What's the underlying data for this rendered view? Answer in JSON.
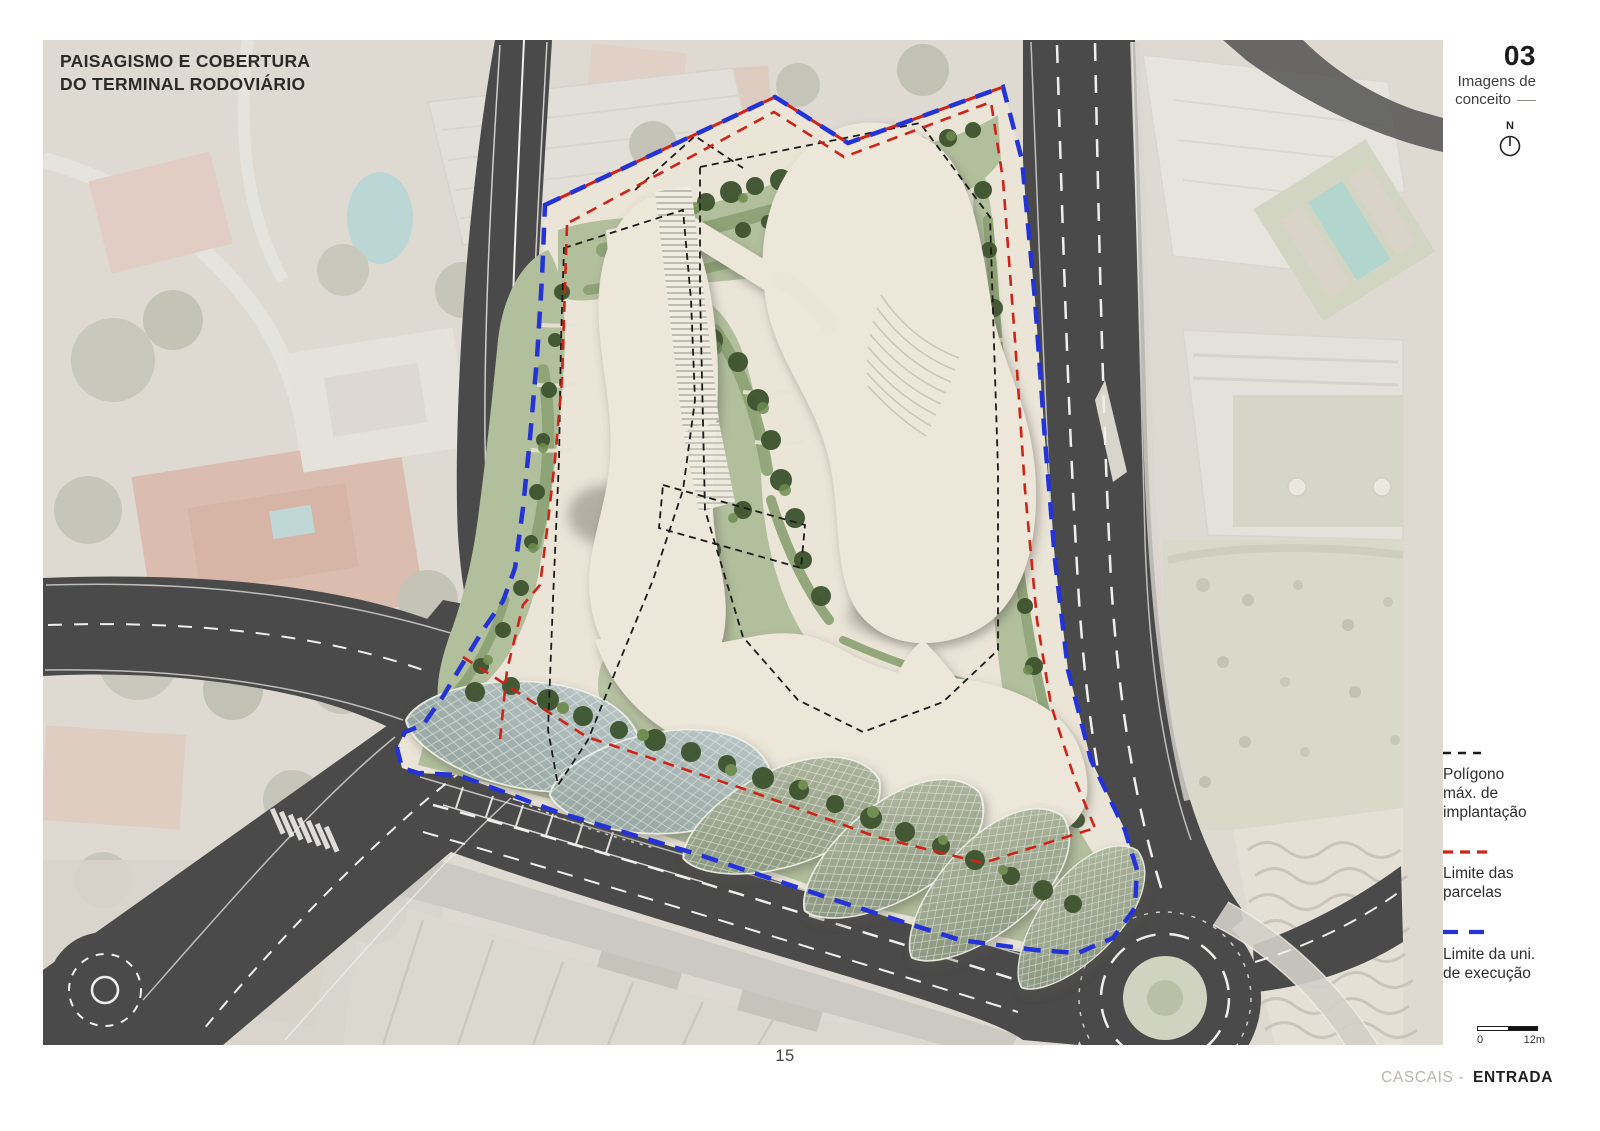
{
  "title": {
    "line1": "PAISAGISMO E COBERTURA",
    "line2": "DO TERMINAL RODOVIÁRIO"
  },
  "header_right": {
    "sheet_number": "03",
    "sheet_label_lines": [
      "Imagens de",
      "conceito"
    ],
    "north_label": "N"
  },
  "legend": {
    "items": [
      {
        "id": "poligono-max-implantacao",
        "lines": [
          "Polígono",
          "máx. de",
          "implantação"
        ],
        "color": "#1b1b1b",
        "line_style": "dashed-thin"
      },
      {
        "id": "limite-parcelas",
        "lines": [
          "Limite das",
          "parcelas"
        ],
        "color": "#cf2218",
        "line_style": "dashed-medium"
      },
      {
        "id": "limite-unidade-execucao",
        "lines": [
          "Limite da uni.",
          "de execução"
        ],
        "color": "#2433d8",
        "line_style": "dashed-thick"
      }
    ]
  },
  "scale_bar": {
    "zero_label": "0",
    "max_label": "12m"
  },
  "footer": {
    "page_number": "15",
    "location_prefix": "CASCAIS -",
    "location_emphasis": "ENTRADA"
  },
  "map": {
    "colors": {
      "unit_boundary_blue": "#2433d8",
      "parcel_limit_red": "#cf2218",
      "implantation_polygon_black": "#1b1b1b",
      "road_asphalt": "#4a4a4a",
      "plaza_cream": "#eae5d7",
      "vegetation_light": "#b2bf9d",
      "vegetation_dark": "#3e5530",
      "glass_canopy_gray_green": "#a7b4ac",
      "aerial_photo_base": "#dedad2"
    }
  }
}
